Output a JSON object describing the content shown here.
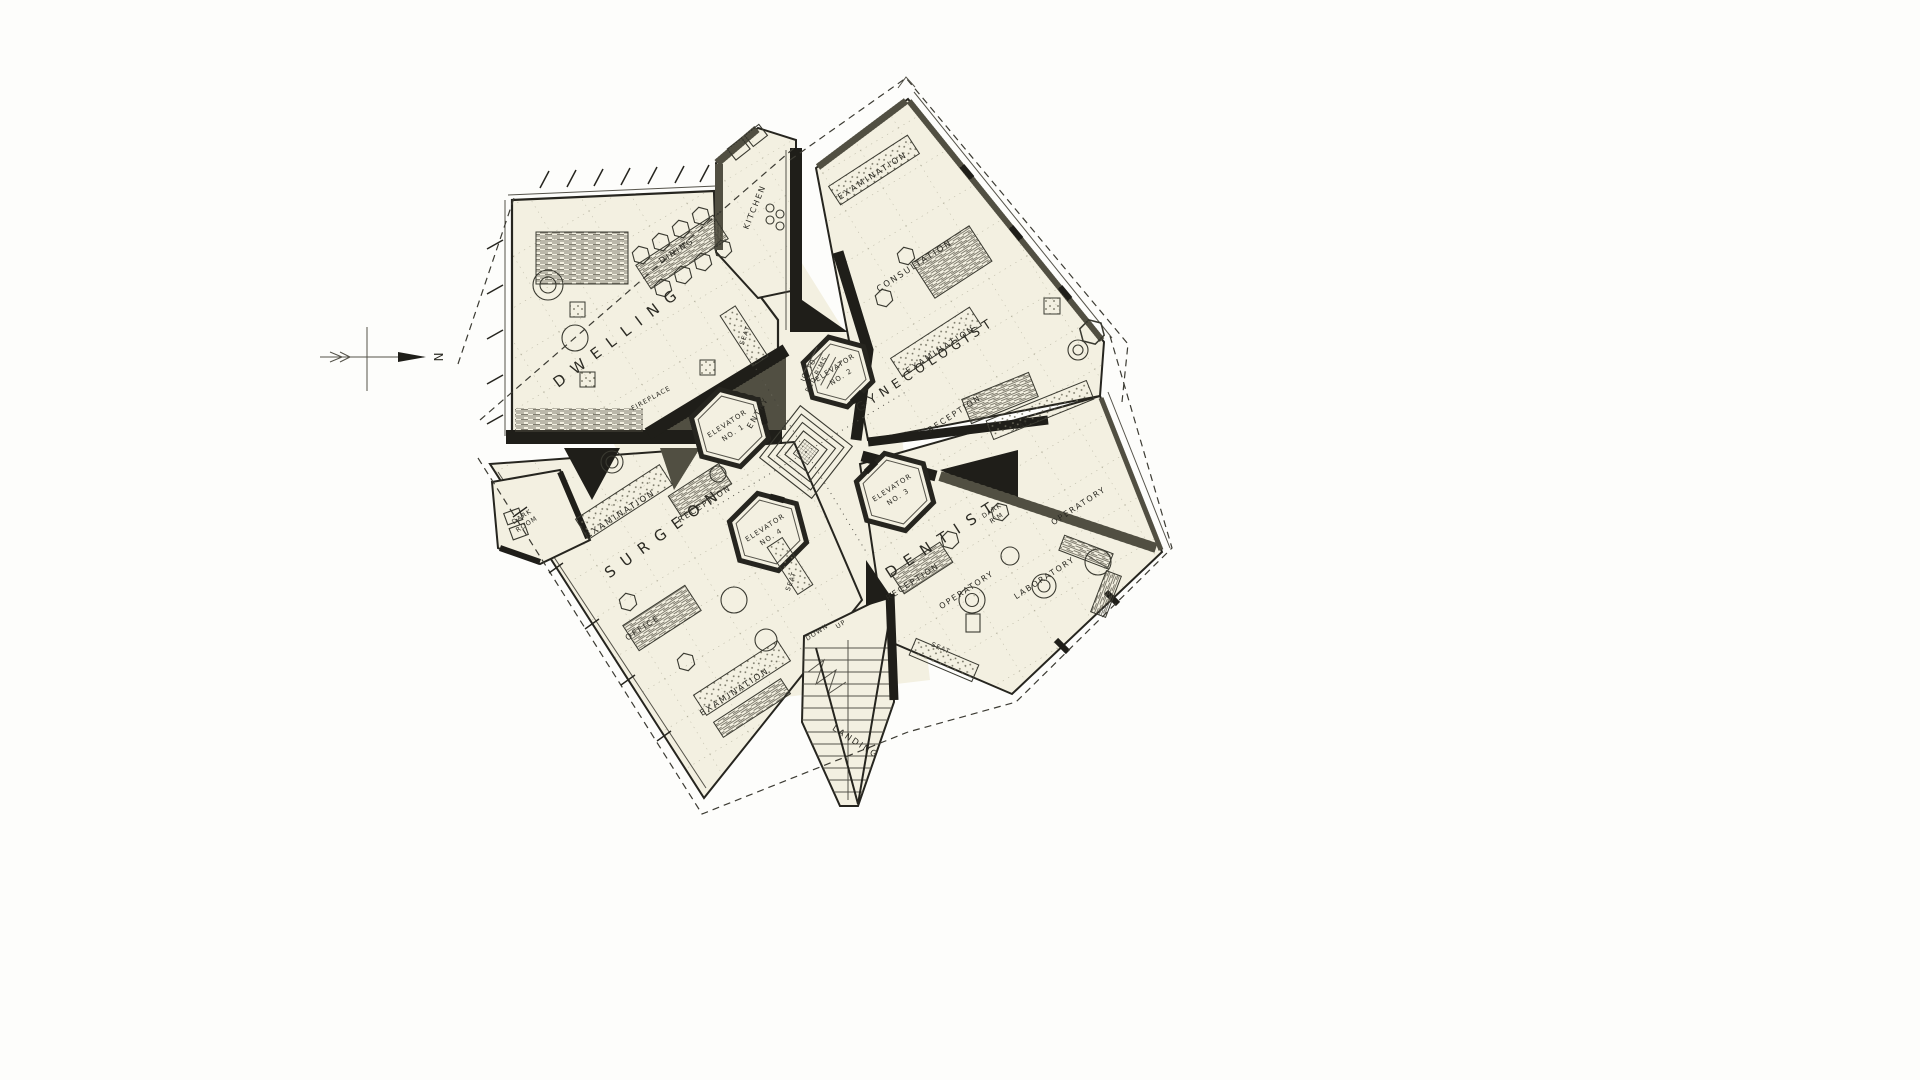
{
  "page": {
    "background": "#fdfdfb",
    "paper": "#f3f0e1",
    "ink": "#26251f"
  },
  "compass": {
    "north": "N"
  },
  "rooms": {
    "dwelling": {
      "name": "DWELLING",
      "labels": {
        "dining": "DINING",
        "kitchen": "KITCHEN",
        "fireplace": "FIREPLACE",
        "seat": "SEAT"
      }
    },
    "gynecologist": {
      "name": "GYNECOLOGIST",
      "labels": {
        "examination_upper": "EXAMINATION",
        "consultation": "CONSULTATION",
        "examination_lower": "EXAMINATION",
        "reception": "RECEPTION",
        "seat": "SEAT",
        "up_to_bedrooms_1": "UP TO",
        "up_to_bedrooms_2": "BED R'MS"
      }
    },
    "surgeon": {
      "name": "SURGEON",
      "labels": {
        "dark_room_1": "DARK",
        "dark_room_2": "ROOM",
        "examination_upper": "EXAMINATION",
        "reception": "RECEPTION",
        "office": "OFFICE",
        "examination_lower": "EXAMINATION",
        "seat": "SEAT"
      }
    },
    "dentist": {
      "name": "DENTIST",
      "labels": {
        "dark_room_1": "DARK",
        "dark_room_2": "R'M",
        "reception": "RECEPTION",
        "operatory_left": "OPERATORY",
        "operatory_right": "OPERATORY",
        "laboratory": "LABORATORY",
        "seat": "SEAT"
      }
    }
  },
  "core": {
    "entry": "ENTRY",
    "elevators": [
      {
        "line1": "ELEVATOR",
        "line2": "NO. 1"
      },
      {
        "line1": "ELEVATOR",
        "line2": "NO. 2"
      },
      {
        "line1": "ELEVATOR",
        "line2": "NO. 3"
      },
      {
        "line1": "ELEVATOR",
        "line2": "NO. 4"
      }
    ],
    "stairs": {
      "down": "DOWN",
      "up": "UP",
      "landing": "LANDING"
    }
  }
}
